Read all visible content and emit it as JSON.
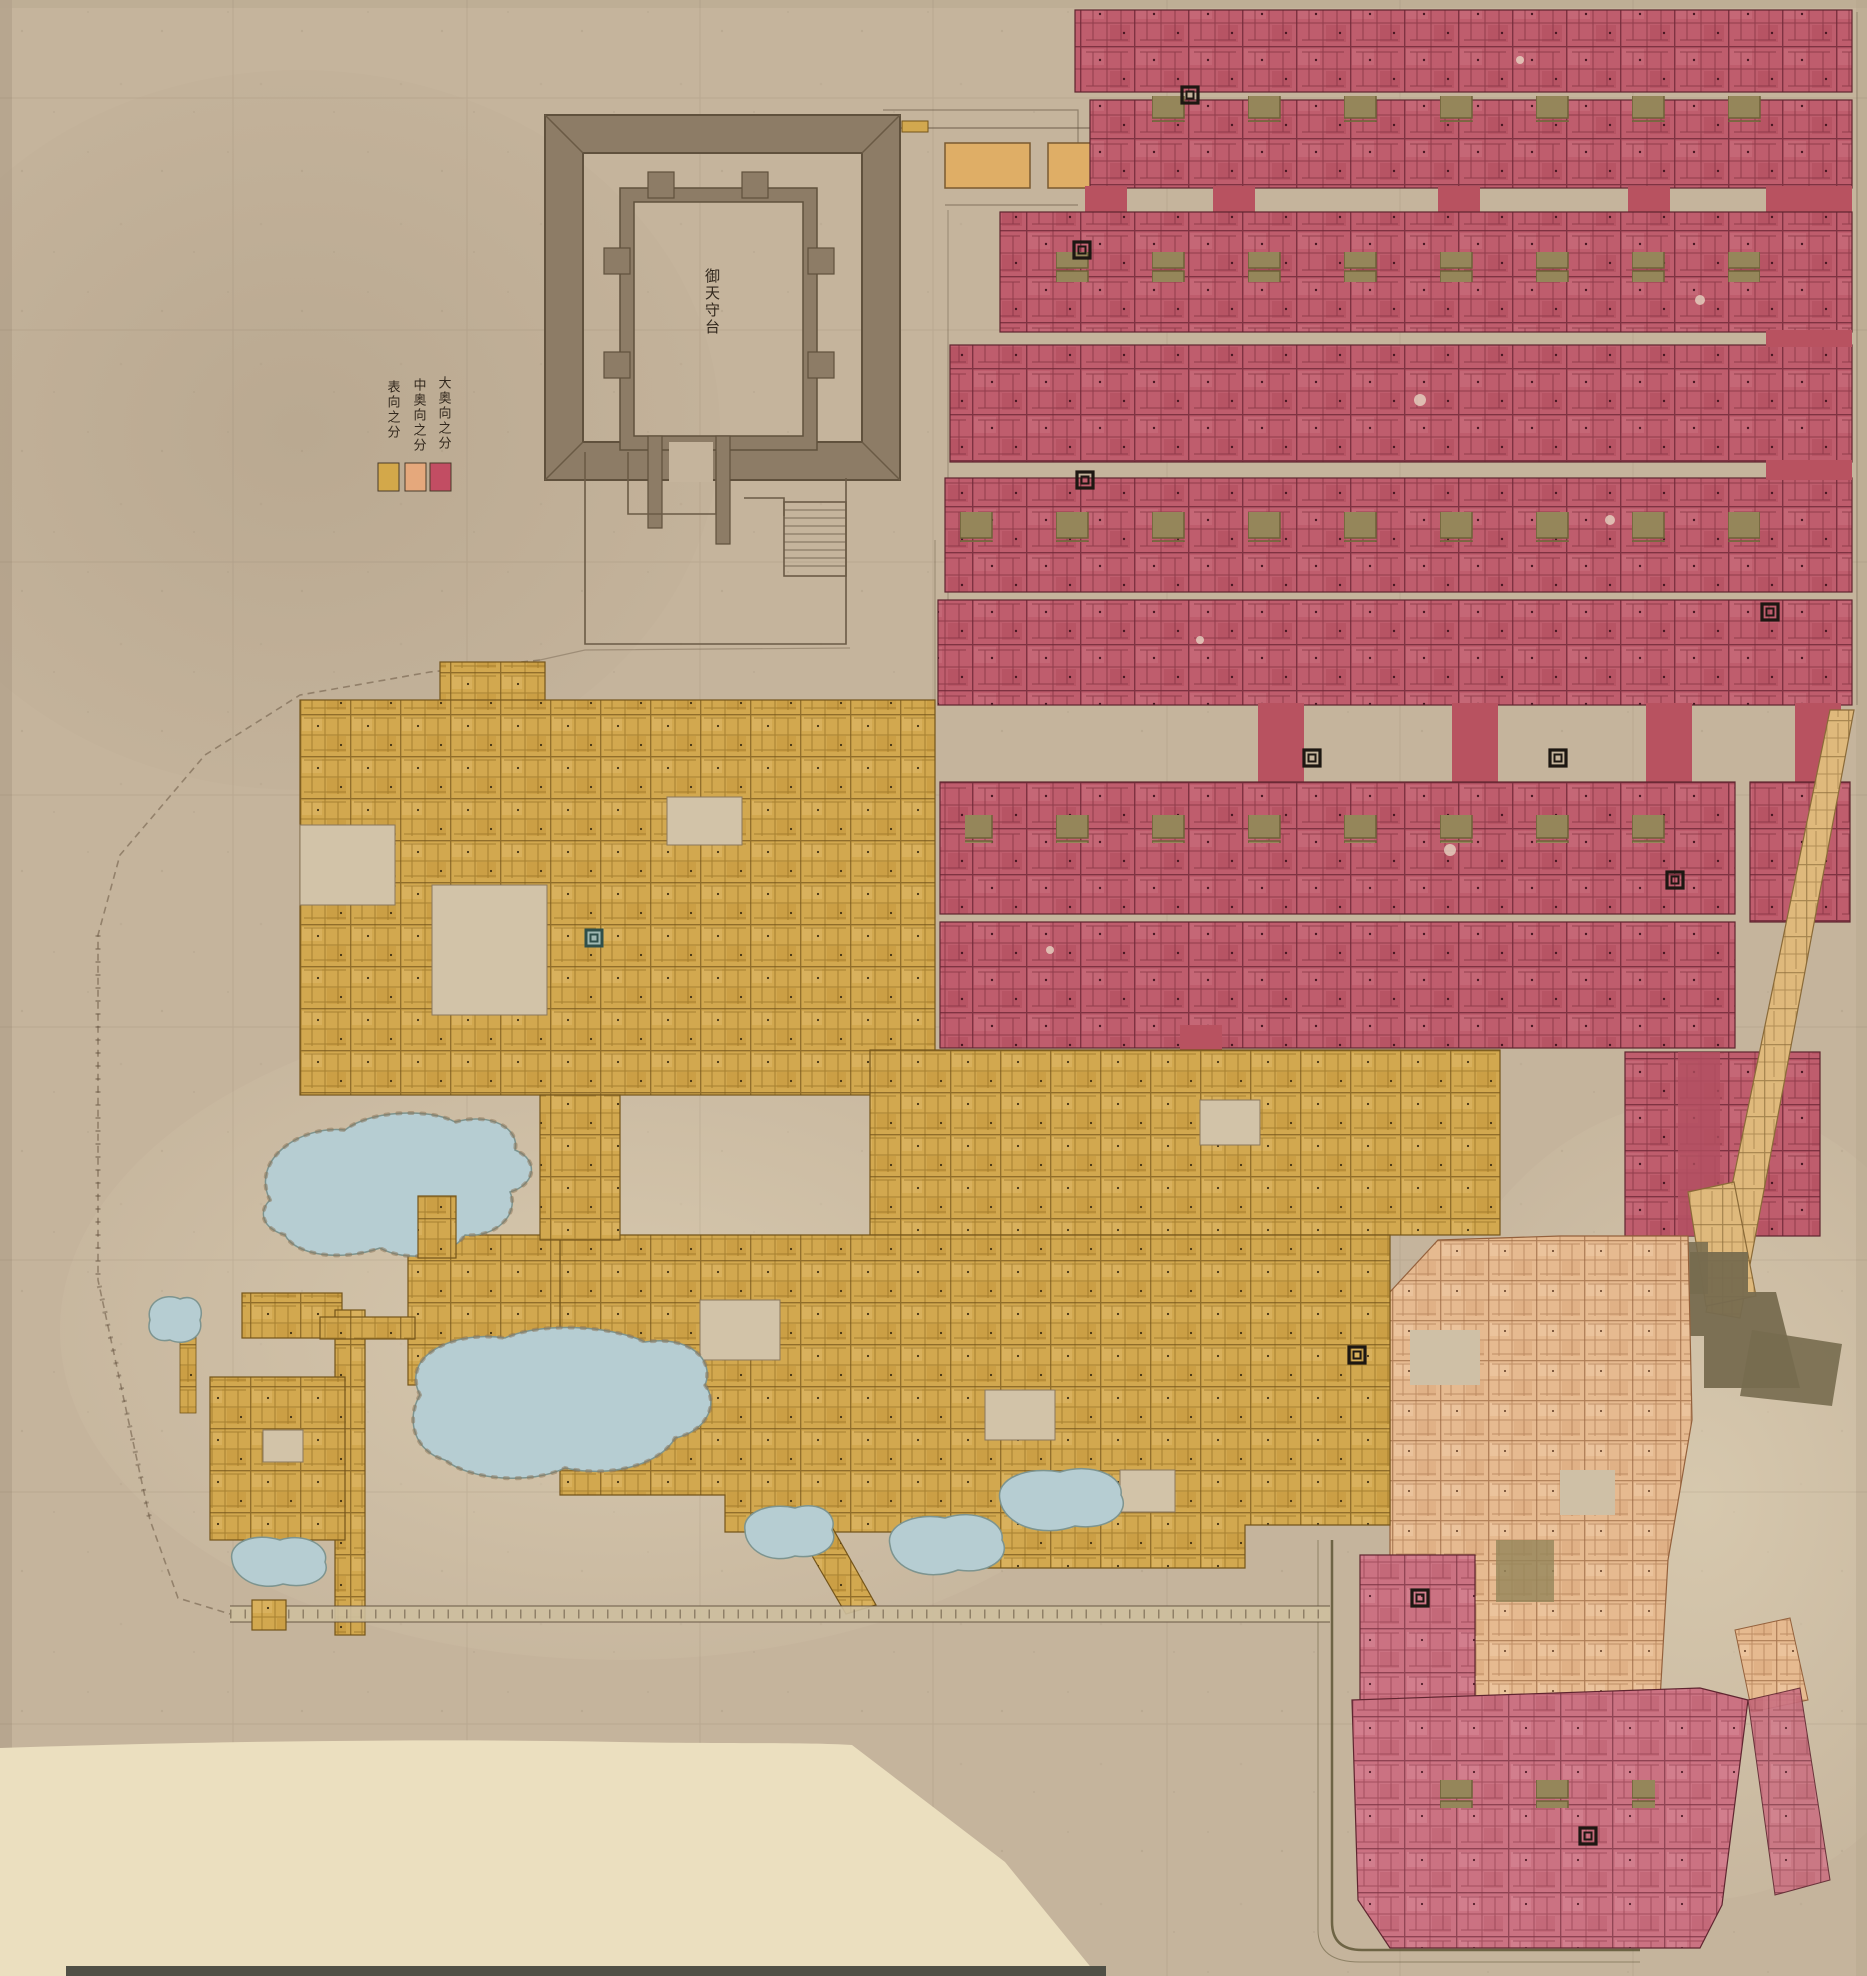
{
  "legend": {
    "entries": [
      {
        "id": "omote",
        "label": "表向之分",
        "color": "#d3a84a"
      },
      {
        "id": "nakaoku",
        "label": "中奥向之分",
        "color": "#e5a87c"
      },
      {
        "id": "ooku",
        "label": "大奥向之分",
        "color": "#c24d63"
      }
    ]
  },
  "keep": {
    "label": "御天守台"
  },
  "palette": {
    "paper": "#c5b49c",
    "paper_light": "#d3c4aa",
    "sheet_cream": "#ebdfbf",
    "omote_yellow": "#d2a84f",
    "nakaoku_salmon": "#e6ba90",
    "ooku_red": "#bf5d6d",
    "storehouse_orange": "#dfae66",
    "stone_wall_gray": "#8d7c66",
    "pond_blue": "#b6cdd2",
    "road_dark": "#776b4f",
    "ink": "#5c4c3a"
  }
}
